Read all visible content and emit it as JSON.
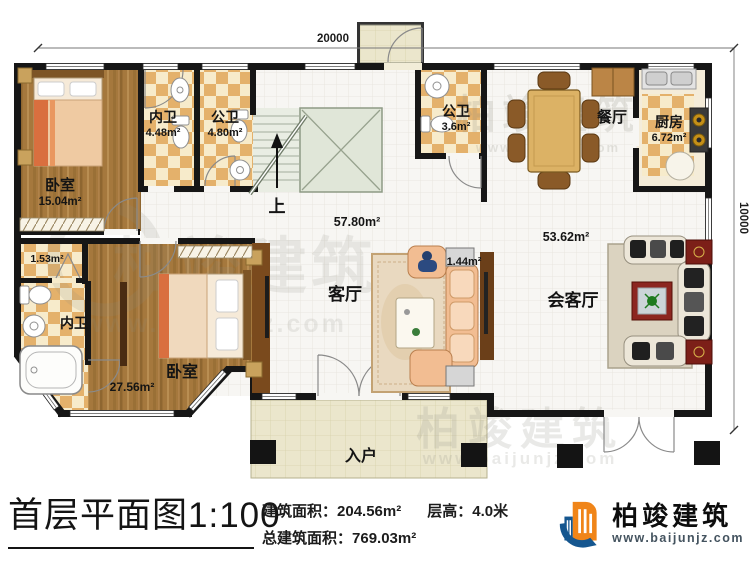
{
  "dimensions": {
    "width_top": "20000",
    "height_right": "10000"
  },
  "rooms": {
    "bedroom_top": {
      "name": "卧室",
      "area": "15.04m²"
    },
    "ensuite_top": {
      "name": "内卫",
      "area": "4.48m²"
    },
    "public_bath_top": {
      "name": "公卫",
      "area": "4.80m²"
    },
    "public_bath_mid": {
      "name": "公卫",
      "area": "3.6m²"
    },
    "dining": {
      "name": "餐厅"
    },
    "kitchen": {
      "name": "厨房",
      "area": "6.72m²"
    },
    "stair": {
      "up_label": "上"
    },
    "living": {
      "name": "客厅",
      "area": "57.80m²"
    },
    "reception": {
      "name": "会客厅",
      "area": "53.62m²"
    },
    "duct": {
      "area": "1.44m²"
    },
    "closet": {
      "area": "1.53m²"
    },
    "ensuite_bottom": {
      "name": "内卫"
    },
    "bedroom_bottom": {
      "name": "卧室",
      "area": "27.56m²"
    },
    "entry_porch": {
      "name": "入户"
    }
  },
  "footer": {
    "title": "首层平面图1:100",
    "building_area_label": "建筑面积：",
    "building_area_value": "204.56m²",
    "floor_height_label": "层高：",
    "floor_height_value": "4.0米",
    "total_area_label": "总建筑面积：",
    "total_area_value": "769.03m²"
  },
  "brand": {
    "name": "柏竣建筑",
    "website": "www.baijunjz.com"
  },
  "watermark": {
    "text": "柏竣建筑",
    "website": "www.baijunjz.com"
  },
  "colors": {
    "wall": "#161616",
    "wood_floor": "#a5783d",
    "tile_accent": "#e4b16b",
    "brand_blue": "#15568f",
    "brand_orange": "#f08519",
    "red_table": "#7c1f18"
  }
}
